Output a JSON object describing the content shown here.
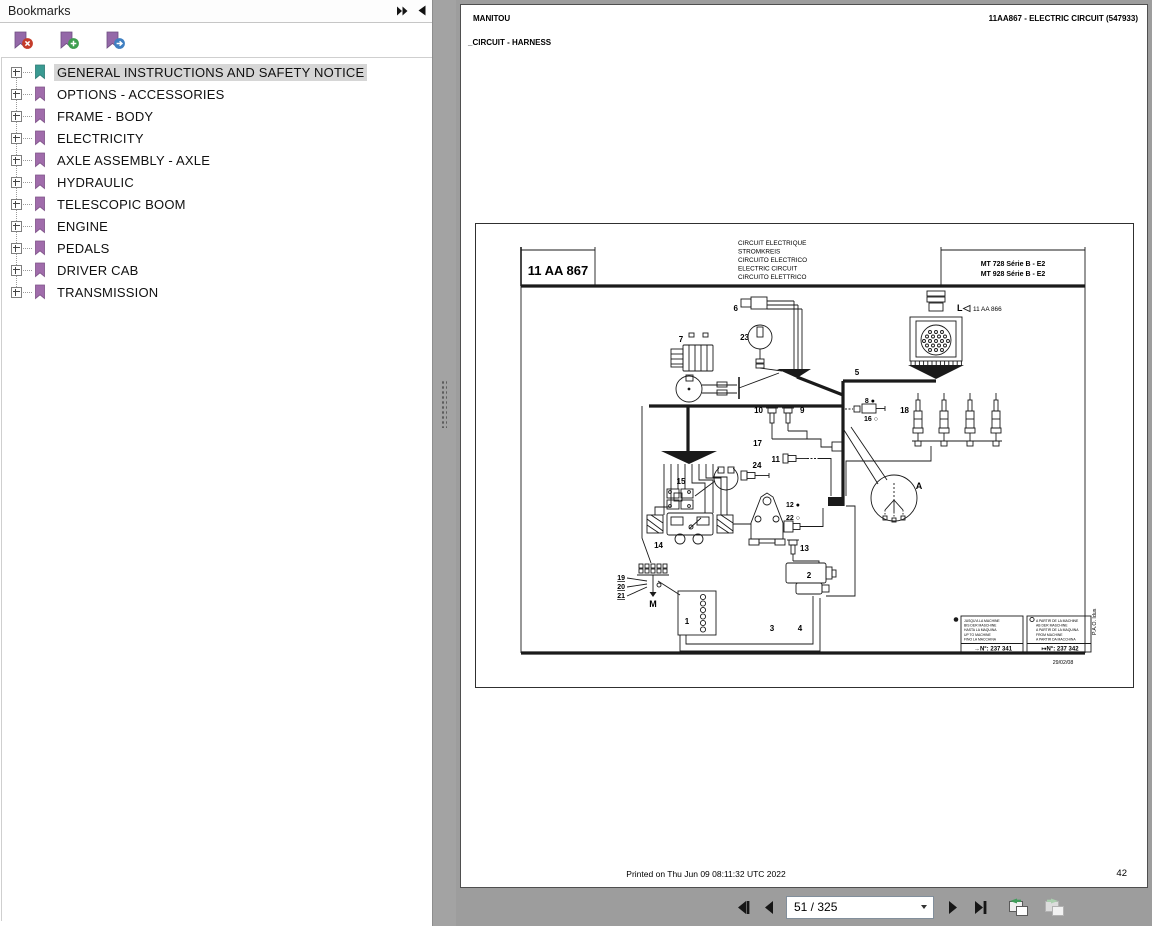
{
  "window": {
    "background": "#9d9d9d"
  },
  "bookmarks_panel": {
    "title": "Bookmarks",
    "toolbar": {
      "buttons": [
        {
          "name": "remove-bookmark",
          "badge": "x",
          "badge_color": "#c43b2a",
          "ribbon_color": "#9468a8"
        },
        {
          "name": "add-bookmark",
          "badge": "+",
          "badge_color": "#3e9e4f",
          "ribbon_color": "#9468a8"
        },
        {
          "name": "goto-bookmark",
          "badge": "→",
          "badge_color": "#3f7fc1",
          "ribbon_color": "#9468a8"
        }
      ]
    },
    "items": [
      {
        "label": "GENERAL INSTRUCTIONS AND SAFETY NOTICE",
        "selected": true,
        "icon_color": "#3a9a92"
      },
      {
        "label": "OPTIONS - ACCESSORIES",
        "selected": false,
        "icon_color": "#a06cab"
      },
      {
        "label": "FRAME - BODY",
        "selected": false,
        "icon_color": "#a06cab"
      },
      {
        "label": "ELECTRICITY",
        "selected": false,
        "icon_color": "#a06cab"
      },
      {
        "label": "AXLE ASSEMBLY - AXLE",
        "selected": false,
        "icon_color": "#a06cab"
      },
      {
        "label": "HYDRAULIC",
        "selected": false,
        "icon_color": "#a06cab"
      },
      {
        "label": "TELESCOPIC BOOM",
        "selected": false,
        "icon_color": "#a06cab"
      },
      {
        "label": "ENGINE",
        "selected": false,
        "icon_color": "#a06cab"
      },
      {
        "label": "PEDALS",
        "selected": false,
        "icon_color": "#a06cab"
      },
      {
        "label": "DRIVER CAB",
        "selected": false,
        "icon_color": "#a06cab"
      },
      {
        "label": "TRANSMISSION",
        "selected": false,
        "icon_color": "#a06cab"
      }
    ]
  },
  "document": {
    "header_left": "MANITOU",
    "header_right": "11AA867 - ELECTRIC CIRCUIT (547933)",
    "subtitle": "_CIRCUIT - HARNESS",
    "printed_line": "Printed on  Thu Jun 09 08:11:32 UTC 2022",
    "page_number": "42"
  },
  "diagram": {
    "ref_box": "11 AA 867",
    "title_lines": [
      "CIRCUIT ELECTRIQUE",
      "STROMKREIS",
      "CIRCUITO ELECTRICO",
      "ELECTRIC CIRCUIT",
      "CIRCUITO ELETTRICO"
    ],
    "model_lines": [
      "MT 728 Série B - E2",
      "MT 928 Série B - E2"
    ],
    "connector": {
      "label": "L",
      "ref": "11 AA 866"
    },
    "callout_label": "A",
    "ground_label": "M",
    "part_labels": {
      "1": "1",
      "2": "2",
      "3": "3",
      "4": "4",
      "5": "5",
      "6": "6",
      "7": "7",
      "8": "8 ●",
      "9": "9",
      "10": "10",
      "11": "11",
      "12": "12 ●",
      "13": "13",
      "14": "14",
      "15": "15",
      "16": "16 ○",
      "17": "17",
      "18": "18",
      "19": "19",
      "20": "20",
      "21": "21",
      "22": "22 ○",
      "23": "23",
      "24": "24"
    },
    "legend_left": {
      "marker": "●",
      "lines": [
        "JUSQU'A LA MACHINE",
        "BIS DER MASCHINE",
        "HASTA LA MAQUINA",
        "UP TO MACHINE",
        "FINO LA MACCHINA"
      ],
      "footer": "→N°: 237 341"
    },
    "legend_right": {
      "marker": "○",
      "lines": [
        "A PARTIR DE LA MACHINE",
        "AB DER MASCHINE",
        "A PARTIR DE LA MAQUINA",
        "FROM MACHINE",
        "A PARTIR DA MACCHINA"
      ],
      "footer": "↦N°: 237 342"
    },
    "date": "29/02/08",
    "side_note": "P.A.O. Idus"
  },
  "navbar": {
    "page_display": "51 / 325"
  }
}
